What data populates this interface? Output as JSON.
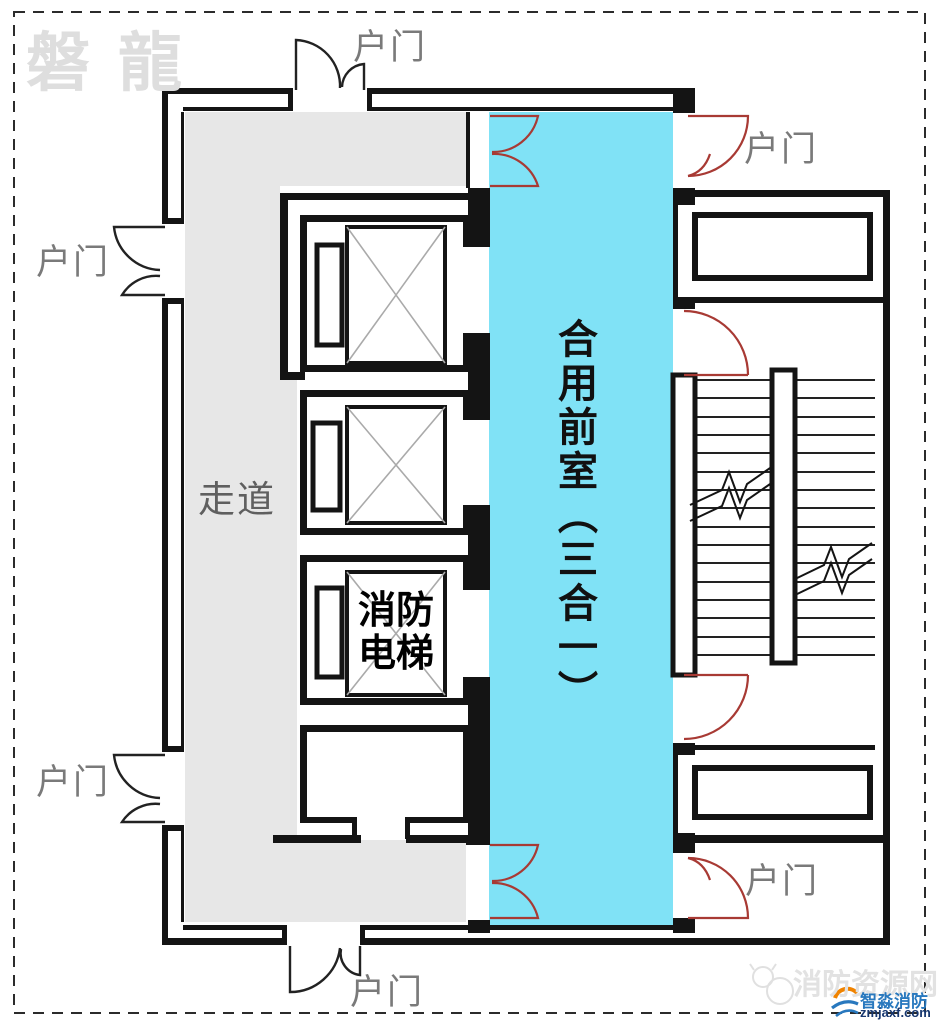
{
  "diagram": {
    "type": "fire-safety floor plan",
    "rooms": {
      "corridor": "走道",
      "front_room": "合用前室（三合一）",
      "fire_elevator": "消防电梯"
    },
    "labels": {
      "entry_door": "户门"
    }
  },
  "watermarks": {
    "top_left": "磐龍",
    "site_name": "消防资源网",
    "brand": "智淼消防",
    "url": "zmjaxf.com"
  },
  "colors": {
    "front_room_fill": "#80E2F6",
    "corridor_fill": "#E7E7E7",
    "wall": "#141414",
    "door_red": "#A83A34",
    "door_black": "#222222",
    "brand_blue": "#2878BE",
    "url_navy": "#16366E",
    "watermark_gray": "#DEDEDE"
  }
}
